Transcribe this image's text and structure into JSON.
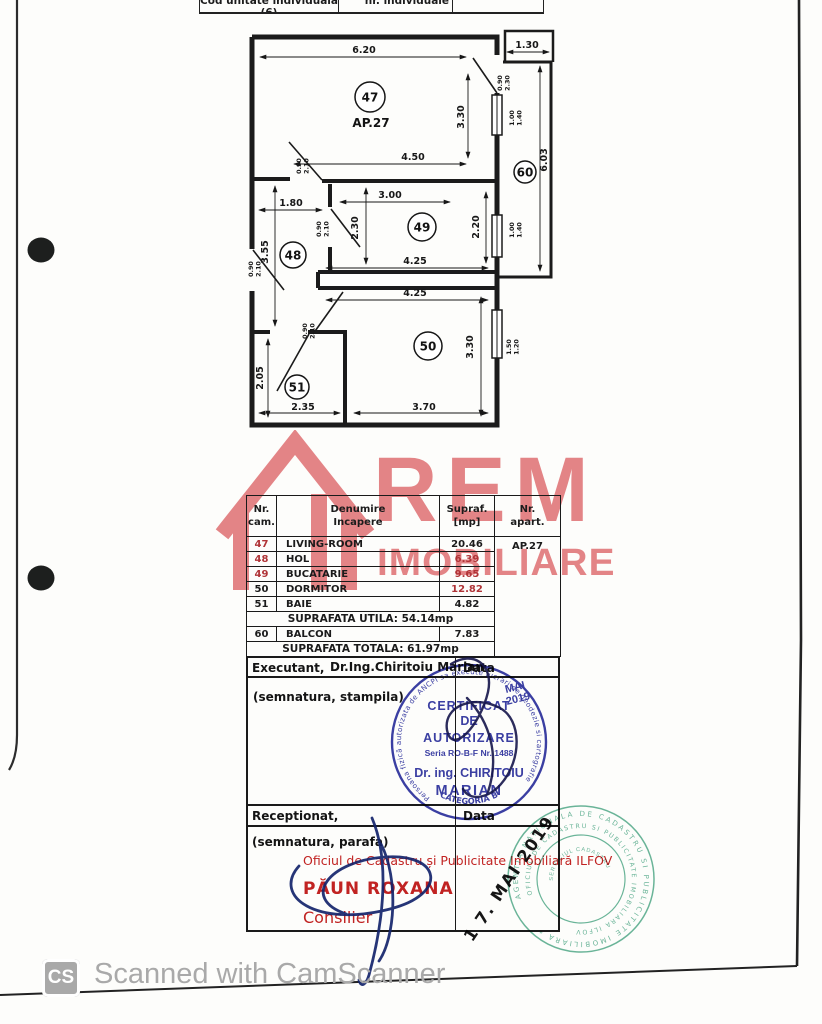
{
  "page": {
    "top_strip": {
      "cells": [
        "Cod unitate individuala (6)",
        "nr. individuale",
        ""
      ]
    },
    "footer": {
      "badge": "CS",
      "text": "Scanned with CamScanner"
    }
  },
  "watermark": {
    "line1": "REM",
    "line2": "IMOBILIARE",
    "color": "#d5393e"
  },
  "plan": {
    "apartment_label": "AP.27",
    "apartment_label_pos": {
      "x": 371,
      "y": 127
    },
    "rooms": [
      {
        "no": "47",
        "x": 370,
        "y": 97,
        "r": 15
      },
      {
        "no": "48",
        "x": 293,
        "y": 255,
        "r": 13
      },
      {
        "no": "49",
        "x": 422,
        "y": 227,
        "r": 14
      },
      {
        "no": "50",
        "x": 428,
        "y": 346,
        "r": 14
      },
      {
        "no": "51",
        "x": 297,
        "y": 387,
        "r": 12
      },
      {
        "no": "60",
        "x": 525,
        "y": 172,
        "r": 11
      }
    ],
    "dims": [
      {
        "t": "6.20",
        "x": 364,
        "y": 53
      },
      {
        "t": "1.30",
        "x": 527,
        "y": 48
      },
      {
        "t": "4.50",
        "x": 413,
        "y": 160
      },
      {
        "t": "1.80",
        "x": 291,
        "y": 206
      },
      {
        "t": "3.00",
        "x": 390,
        "y": 198
      },
      {
        "t": "4.25",
        "x": 415,
        "y": 264
      },
      {
        "t": "4.25",
        "x": 415,
        "y": 296
      },
      {
        "t": "2.35",
        "x": 303,
        "y": 410
      },
      {
        "t": "3.70",
        "x": 424,
        "y": 410
      },
      {
        "t": "3.30",
        "x": 464,
        "y": 117,
        "rot": -90
      },
      {
        "t": "6.03",
        "x": 547,
        "y": 160,
        "rot": -90
      },
      {
        "t": "2.30",
        "x": 358,
        "y": 228,
        "rot": -90
      },
      {
        "t": "2.20",
        "x": 479,
        "y": 227,
        "rot": -90
      },
      {
        "t": "3.55",
        "x": 268,
        "y": 252,
        "rot": -90
      },
      {
        "t": "3.30",
        "x": 473,
        "y": 347,
        "rot": -90
      },
      {
        "t": "2.05",
        "x": 263,
        "y": 378,
        "rot": -90
      },
      {
        "t": "0.90",
        "t2": "2.30",
        "x": 503,
        "y": 83,
        "rot": -90
      },
      {
        "t": "1.00",
        "t2": "1.40",
        "x": 515,
        "y": 118,
        "rot": -90
      },
      {
        "t": "1.00",
        "t2": "1.40",
        "x": 515,
        "y": 230,
        "rot": -90
      },
      {
        "t": "0.90",
        "t2": "2.10",
        "x": 302,
        "y": 166,
        "rot": -90
      },
      {
        "t": "0.90",
        "t2": "2.10",
        "x": 322,
        "y": 229,
        "rot": -90
      },
      {
        "t": "0.90",
        "t2": "2.10",
        "x": 254,
        "y": 269,
        "rot": -90
      },
      {
        "t": "0.90",
        "t2": "2.10",
        "x": 308,
        "y": 331,
        "rot": -90
      },
      {
        "t": "1.50",
        "t2": "1.20",
        "x": 512,
        "y": 347,
        "rot": -90
      }
    ]
  },
  "table": {
    "headers": [
      [
        "Nr.",
        "cam."
      ],
      [
        "Denumire",
        "Incapere"
      ],
      [
        "Supraf.",
        "[mp]"
      ],
      [
        "Nr.",
        "apart."
      ]
    ],
    "rows": [
      {
        "nr": "47",
        "name": "LIVING-ROOM",
        "area": "20.46",
        "nr_red": true,
        "area_red": false
      },
      {
        "nr": "48",
        "name": "HOL",
        "area": "6.39",
        "nr_red": true,
        "area_red": true
      },
      {
        "nr": "49",
        "name": "BUCATARIE",
        "area": "9.65",
        "nr_red": true,
        "area_red": true
      },
      {
        "nr": "50",
        "name": "DORMITOR",
        "area": "12.82",
        "nr_red": false,
        "area_red": true
      },
      {
        "nr": "51",
        "name": "BAIE",
        "area": "4.82",
        "nr_red": false,
        "area_red": false
      }
    ],
    "apartment": "AP.27",
    "utila": "SUPRAFATA  UTILA: 54.14mp",
    "balcon": {
      "nr": "60",
      "name": "BALCON",
      "area": "7.83"
    },
    "totala": "SUPRAFATA TOTALA: 61.97mp"
  },
  "sections": {
    "executant_label": "Executant,",
    "executant_name": "Dr.Ing.Chiritoiu Marian",
    "data_label": "Data",
    "semnatura_stampila": "(semnatura, stampila)",
    "receptionat_label": "Receptionat,",
    "semnatura_parafa": "(semnatura, parafa)"
  },
  "stamps": {
    "authorization": {
      "ring_text": "Persoana fizică autorizata de ANCPI sa execute lucrari de geodezie si cartografie",
      "line1": "CERTIFICAT",
      "line2": "DE",
      "line3": "AUTORIZARE",
      "line4": "Seria RO-B-F Nr. 1488",
      "line5": "Dr. ing. CHIRITOIU",
      "line6": "MARIAN",
      "bottom": "CATEGORIA B",
      "month": "MAI",
      "year": "2019",
      "color": "#2b2f9e"
    },
    "office_red": {
      "line1": "Oficiul de Cadastru și Publicitate Imobiliară ILFOV",
      "name": "PĂUN ROXANA",
      "title": "Consilier",
      "color": "#c32322"
    },
    "date_stamp": "1 7. MAI 2019",
    "office_green": {
      "ring_outer": "AGENTIA NATIONALA DE CADASTRU SI PUBLICITATE IMOBILIARA *",
      "ring_inner": "OFICIUL DE CADASTRU SI PUBLICITATE IMOBILIARA ILFOV",
      "center": "SERVICIUL CADASTRU",
      "color": "#46a482"
    }
  }
}
